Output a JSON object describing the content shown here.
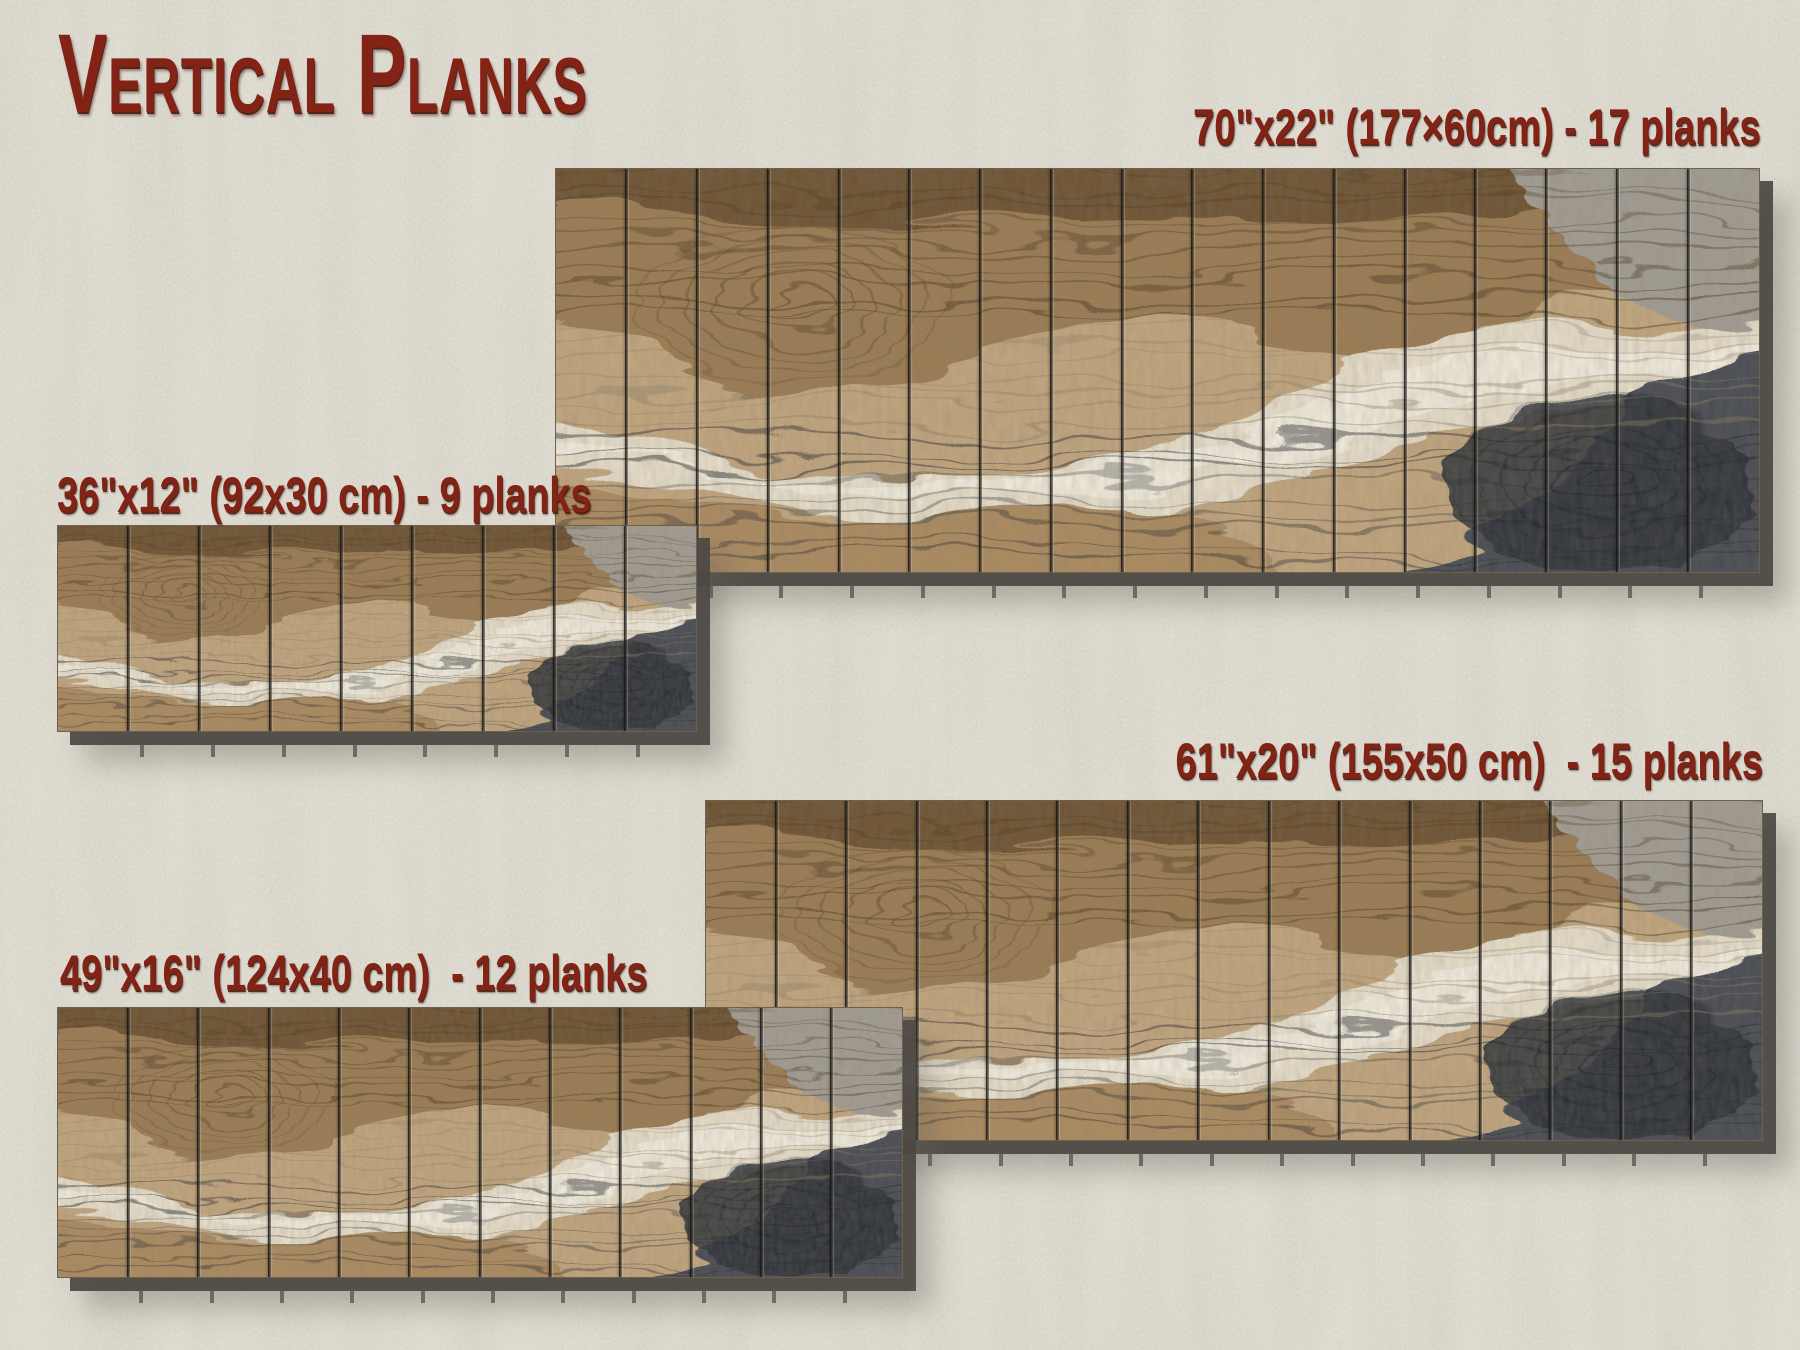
{
  "title": "Vertical Planks",
  "panels": [
    {
      "name": "70x22",
      "size_in": "70\"x22\"",
      "size_cm": "177×60cm",
      "planks": 17,
      "label": "70\"x22\" (177×60cm) - 17 planks"
    },
    {
      "name": "36x12",
      "size_in": "36\"x12\"",
      "size_cm": "92x30 cm",
      "planks": 9,
      "label": "36\"x12\" (92x30 cm) - 9 planks"
    },
    {
      "name": "61x20",
      "size_in": "61\"x20\"",
      "size_cm": "155x50 cm",
      "planks": 15,
      "label": "61\"x20\" (155x50 cm)  - 15 planks"
    },
    {
      "name": "49x16",
      "size_in": "49\"x16\"",
      "size_cm": "124x40 cm",
      "planks": 12,
      "label": "49\"x16\" (124x40 cm)  - 12 planks"
    }
  ],
  "colors": {
    "label_red": "#822316",
    "wall": "#d7d3c7",
    "shadow": "#4b4845",
    "divider": "#23211e",
    "wood_tan": "#b3905f",
    "wood_cream": "#e8e0cc",
    "wood_charcoal": "#3c4147"
  }
}
